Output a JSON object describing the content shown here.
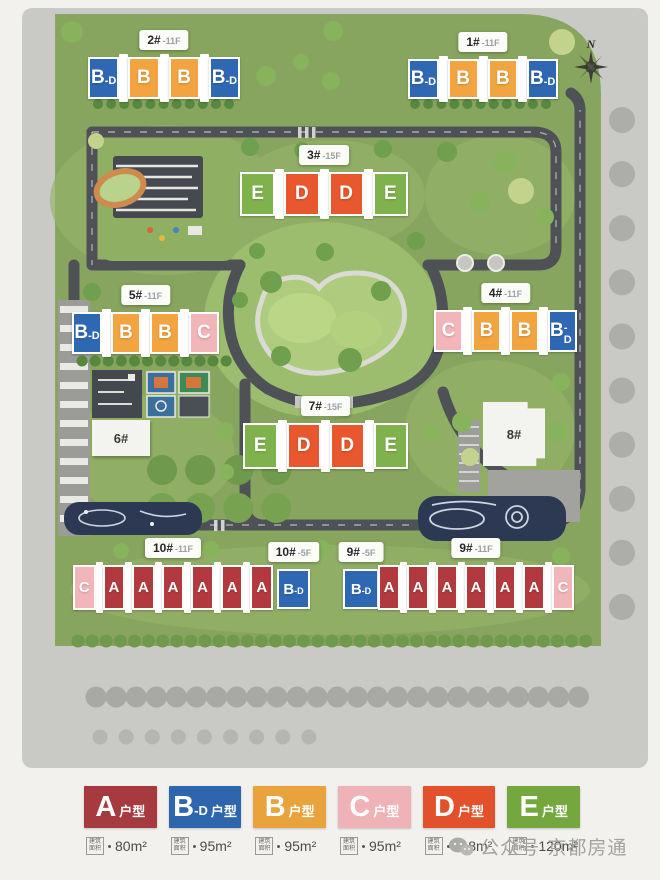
{
  "site_plan": {
    "compass_label": "N",
    "type_colors": {
      "A": "#b23a3e",
      "B-D": "#2f68b2",
      "B": "#f2a440",
      "C": "#f2b5b9",
      "D": "#e8572d",
      "E": "#7fb24d"
    },
    "buildings": [
      {
        "id": "2#",
        "floors": "-11F",
        "units": [
          "B-D",
          "B",
          "B",
          "B-D"
        ]
      },
      {
        "id": "1#",
        "floors": "-11F",
        "units": [
          "B-D",
          "B",
          "B",
          "B-D"
        ]
      },
      {
        "id": "3#",
        "floors": "-15F",
        "units": [
          "E",
          "D",
          "D",
          "E"
        ]
      },
      {
        "id": "5#",
        "floors": "-11F",
        "units": [
          "B-D",
          "B",
          "B",
          "C"
        ]
      },
      {
        "id": "4#",
        "floors": "-11F",
        "units": [
          "C",
          "B",
          "B",
          "B-D"
        ]
      },
      {
        "id": "7#",
        "floors": "-15F",
        "units": [
          "E",
          "D",
          "D",
          "E"
        ]
      },
      {
        "id": "10#",
        "floors": "-11F",
        "units": [
          "C",
          "A",
          "A",
          "A",
          "A",
          "A",
          "A"
        ]
      },
      {
        "id": "10#",
        "floors": "-5F",
        "units": [
          "B-D"
        ]
      },
      {
        "id": "9#",
        "floors": "-5F",
        "units": [
          "B-D"
        ]
      },
      {
        "id": "9#",
        "floors": "-11F",
        "units": [
          "A",
          "A",
          "A",
          "A",
          "A",
          "A",
          "C"
        ]
      }
    ],
    "plain_buildings": [
      {
        "id": "6#"
      },
      {
        "id": "8#"
      }
    ]
  },
  "legend": {
    "area_tag": "建筑面积",
    "items": [
      {
        "letter": "A",
        "letter_sub": "",
        "suffix": "户型",
        "area": "80m²",
        "color": "#a63a3e"
      },
      {
        "letter": "B",
        "letter_sub": "-D",
        "suffix": "户型",
        "area": "95m²",
        "color": "#2d66ac"
      },
      {
        "letter": "B",
        "letter_sub": "",
        "suffix": "户型",
        "area": "95m²",
        "color": "#e8a33c"
      },
      {
        "letter": "C",
        "letter_sub": "",
        "suffix": "户型",
        "area": "95m²",
        "color": "#efb2b6"
      },
      {
        "letter": "D",
        "letter_sub": "",
        "suffix": "户型",
        "area": "118m²",
        "color": "#e2512b"
      },
      {
        "letter": "E",
        "letter_sub": "",
        "suffix": "户型",
        "area": "120m²",
        "color": "#74a83f"
      }
    ]
  },
  "watermark": {
    "text": "公众号·京都房通"
  }
}
